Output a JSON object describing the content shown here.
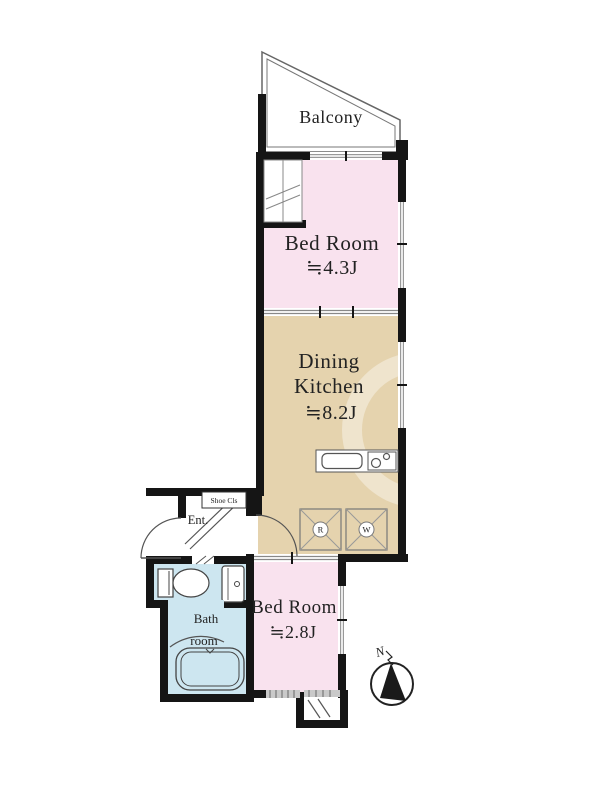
{
  "colors": {
    "wall": "#151515",
    "bedroom": "#f9e2ee",
    "dining": "#e5d3ae",
    "bath": "#cde6f0",
    "line": "#555555",
    "hatch": "#c9c9c9"
  },
  "rooms": {
    "balcony": {
      "label": "Balcony"
    },
    "bedroom1": {
      "label": "Bed Room",
      "size": "≒4.3J"
    },
    "dining_kitchen": {
      "label_line1": "Dining",
      "label_line2": "Kitchen",
      "size": "≒8.2J"
    },
    "bedroom2": {
      "label": "Bed Room",
      "size": "≒2.8J"
    },
    "bathroom": {
      "label_line1": "Bath",
      "label_line2": "room"
    },
    "entrance": {
      "label": "Ent."
    },
    "shoe_closet": {
      "label": "Shoe Cls"
    }
  },
  "appliances": {
    "refrigerator": "R",
    "washer": "W"
  },
  "compass": {
    "label": "N"
  }
}
